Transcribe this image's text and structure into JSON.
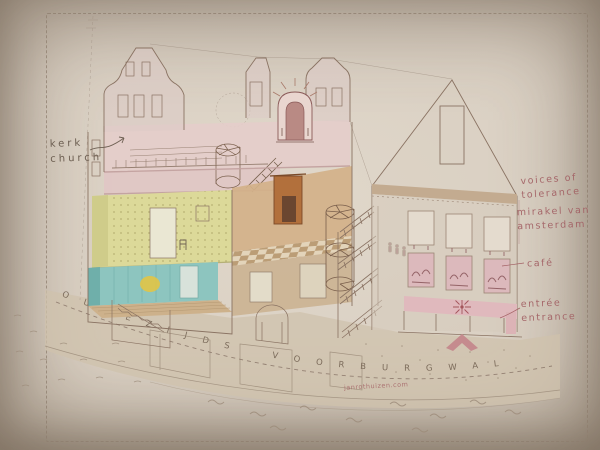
{
  "scene": {
    "description": "Hand-drawn axonometric cutaway illustration of an Amsterdam canal-house museum with hidden attic church, photographed on cream paper",
    "credit_text": "janrothuizen.com"
  },
  "labels": {
    "kerk": {
      "line1": "kerk",
      "line2": "church"
    },
    "voices": {
      "line1": "voices of",
      "line2": "tolerance"
    },
    "mirakel": {
      "line1": "mirakel van",
      "line2": "amsterdam"
    },
    "cafe": {
      "text": "café"
    },
    "entree": {
      "line1": "entrée",
      "line2": "entrance"
    }
  },
  "street": {
    "name": "Oudezijds Voorburgwal",
    "display": "OUDEZIJDS VOORBURGWAL"
  },
  "colors": {
    "paper": "#dad0c3",
    "ink": "#8a7363",
    "label_ink": "#6b5d50",
    "label_pink": "#a25f63",
    "church_pink": "#e3cbc8",
    "chartreuse_room": "#dcd999",
    "teal_room": "#8dc5bf",
    "wood_floor": "#cdb18b",
    "tan_room": "#d2b189",
    "fireplace_orange": "#b2703c",
    "awning_pink": "#e0b9bd",
    "lamp_yellow": "#e6c43e"
  }
}
